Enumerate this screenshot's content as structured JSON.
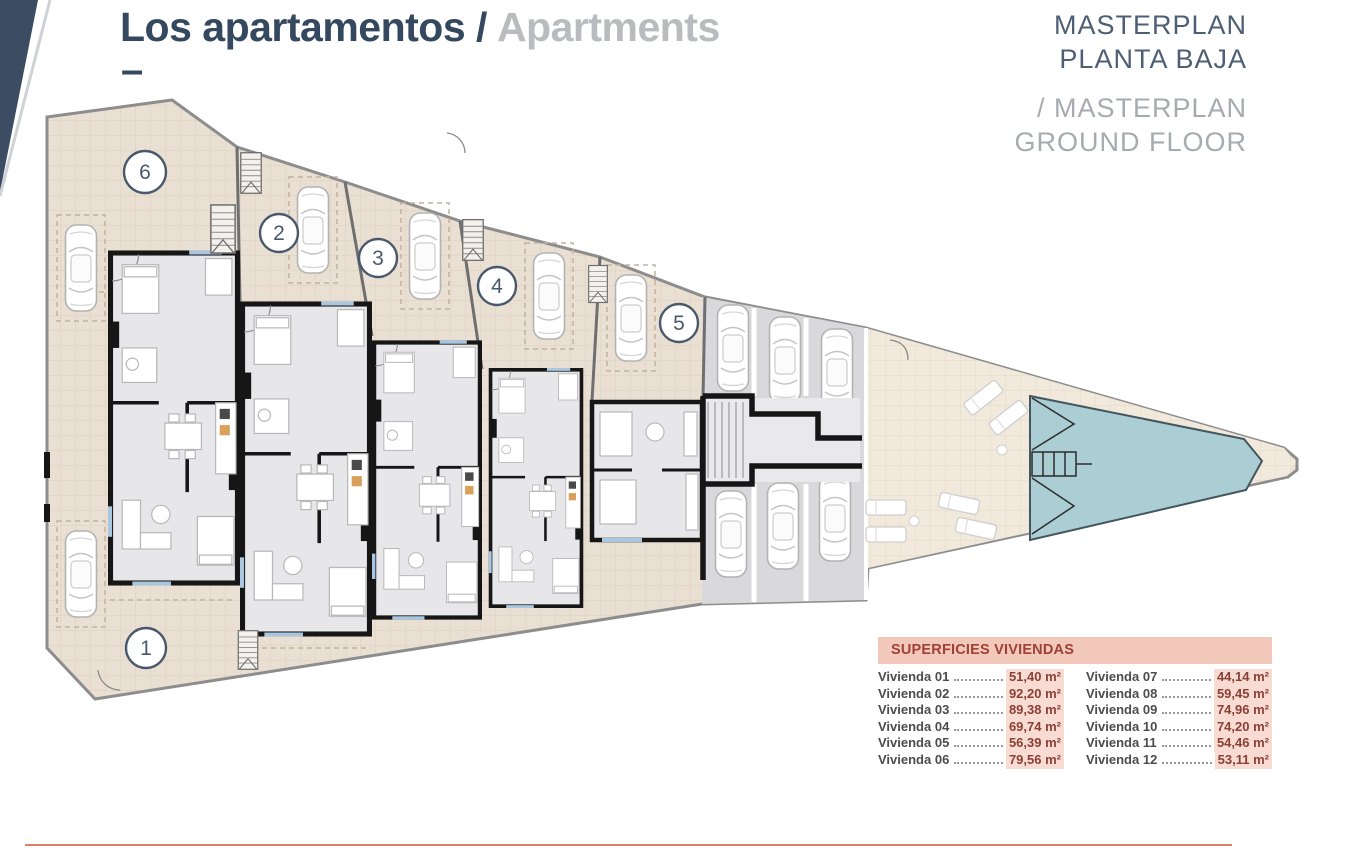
{
  "header": {
    "title_primary": "Los apartamentos /",
    "title_secondary": "Apartments",
    "dash": "–",
    "masterplan": {
      "line1": "MASTERPLAN",
      "line2": "PLANTA BAJA",
      "line3": "/ MASTERPLAN",
      "line4": "GROUND FLOOR"
    }
  },
  "plan": {
    "units": [
      "1",
      "2",
      "3",
      "4",
      "5",
      "6"
    ]
  },
  "areas_table": {
    "header": "SUPERFICIES VIVIENDAS",
    "left": [
      {
        "label": "Vivienda 01",
        "value": "51,40 m²"
      },
      {
        "label": "Vivienda 02",
        "value": "92,20 m²"
      },
      {
        "label": "Vivienda 03",
        "value": "89,38 m²"
      },
      {
        "label": "Vivienda 04",
        "value": "69,74 m²"
      },
      {
        "label": "Vivienda 05",
        "value": "56,39 m²"
      },
      {
        "label": "Vivienda 06",
        "value": "79,56 m²"
      }
    ],
    "right": [
      {
        "label": "Vivienda 07",
        "value": "44,14 m²"
      },
      {
        "label": "Vivienda 08",
        "value": "59,45 m²"
      },
      {
        "label": "Vivienda 09",
        "value": "74,96 m²"
      },
      {
        "label": "Vivienda 10",
        "value": "74,20 m²"
      },
      {
        "label": "Vivienda 11",
        "value": "54,46 m²"
      },
      {
        "label": "Vivienda 12",
        "value": "53,11 m²"
      }
    ]
  },
  "colors": {
    "title_navy": "#34485f",
    "title_gray": "#b9bbbe",
    "masterplan_dark": "#4d5f75",
    "masterplan_gray": "#a6abb1",
    "corner_ribbon_navy": "#3c4c63",
    "table_header_bg": "#f2c8bb",
    "table_header_text": "#9f4136",
    "value_highlight_bg": "#f8dbd2",
    "value_text": "#8a4035",
    "accent_line": "#dd8166",
    "terrace_beige": "#e9dfd2",
    "terrace_light": "#f1e9dc",
    "parking_gray": "#d9d9db",
    "pool_teal": "#abced5",
    "wall_black": "#161616"
  }
}
